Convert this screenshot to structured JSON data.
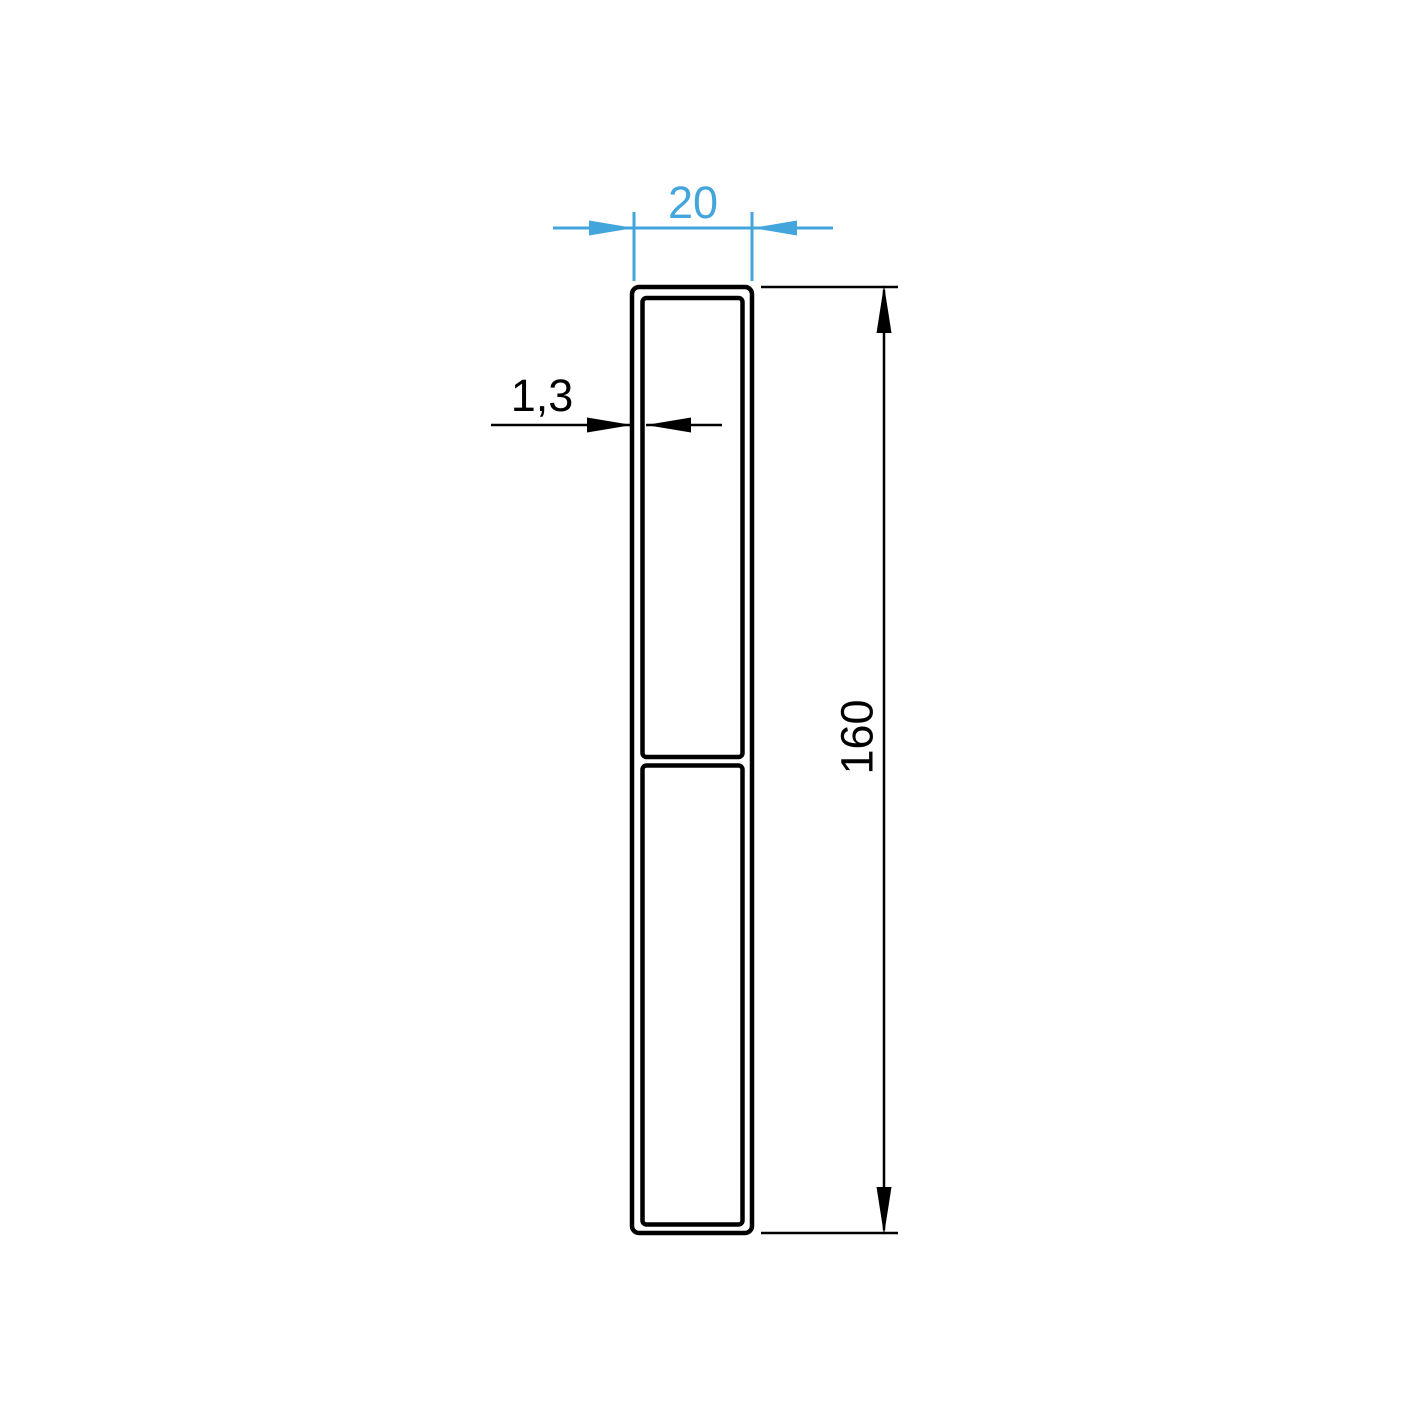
{
  "drawing": {
    "dimensions": {
      "width": {
        "label": "20"
      },
      "thickness": {
        "label": "1,3"
      },
      "height": {
        "label": "160"
      }
    },
    "colors": {
      "accent_blue": "#42a5dc",
      "line_black": "#000000",
      "background": "#ffffff"
    }
  }
}
